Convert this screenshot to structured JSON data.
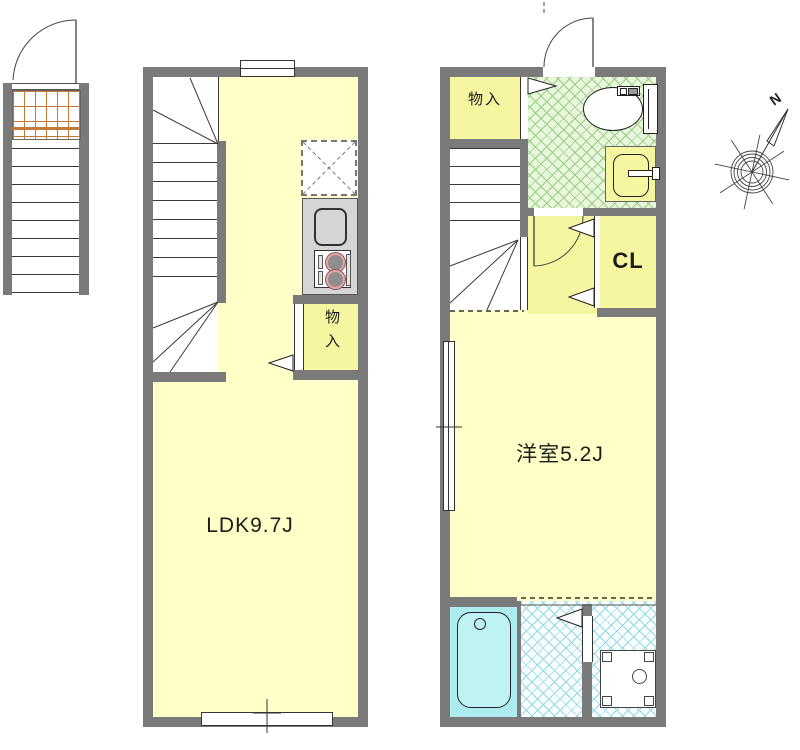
{
  "plans": {
    "left": {
      "room_label": "LDK9.7J",
      "closet_label": "物入"
    },
    "right": {
      "storage_label": "物入",
      "closet_label": "CL",
      "room_label": "洋室5.2J"
    }
  },
  "compass": {
    "north_label": "N"
  },
  "colors": {
    "wall": "#7a7a7a",
    "room_fill": "#ffffc8",
    "service_fill": "#f6f6a0",
    "toilet_floor": "#ebf6de",
    "toilet_hatch_line": "#93cf81",
    "bath_fill": "#adedef",
    "washroom_hatch_line": "#8ed9e8",
    "kitchen_counter": "#d5d5d5",
    "burner_ring": "#f2a0a0",
    "grating_line": "#c27a35"
  },
  "fixtures": [
    "external-stairs",
    "grating-porch",
    "entrance-door",
    "stairs",
    "refrigerator-space",
    "kitchen-sink",
    "stove",
    "storage-closet",
    "toilet",
    "washbasin",
    "closet",
    "bathtub",
    "washing-machine-pan",
    "window"
  ]
}
